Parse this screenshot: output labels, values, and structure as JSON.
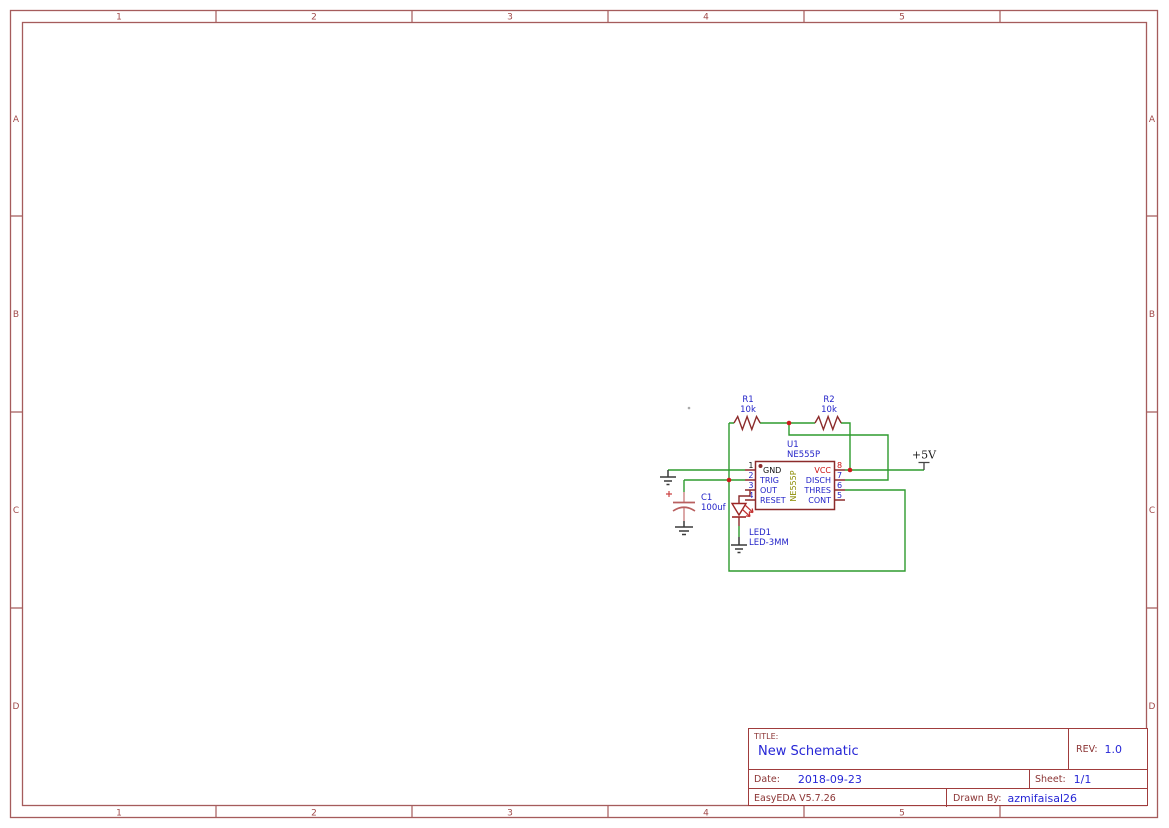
{
  "frame": {
    "columns": [
      "1",
      "2",
      "3",
      "4",
      "5"
    ],
    "rows": [
      "A",
      "B",
      "C",
      "D"
    ]
  },
  "title_block": {
    "title_label": "TITLE:",
    "title": "New Schematic",
    "rev_label": "REV:",
    "rev": "1.0",
    "date_label": "Date:",
    "date": "2018-09-23",
    "sheet_label": "Sheet:",
    "sheet": "1/1",
    "tool_version": "EasyEDA V5.7.26",
    "drawn_by_label": "Drawn By:",
    "drawn_by": "azmifaisal26"
  },
  "schematic": {
    "power_flag": "+5V",
    "resistors": [
      {
        "ref": "R1",
        "value": "10k"
      },
      {
        "ref": "R2",
        "value": "10k"
      }
    ],
    "ic": {
      "ref": "U1",
      "part": "NE555P",
      "body_label": "NE555P",
      "left_pins": [
        {
          "num": "1",
          "name": "GND"
        },
        {
          "num": "2",
          "name": "TRIG"
        },
        {
          "num": "3",
          "name": "OUT"
        },
        {
          "num": "4",
          "name": "RESET"
        }
      ],
      "right_pins": [
        {
          "num": "8",
          "name": "VCC"
        },
        {
          "num": "7",
          "name": "DISCH"
        },
        {
          "num": "6",
          "name": "THRES"
        },
        {
          "num": "5",
          "name": "CONT"
        }
      ]
    },
    "capacitor": {
      "ref": "C1",
      "value": "100uf"
    },
    "led": {
      "ref": "LED1",
      "value": "LED-3MM"
    }
  },
  "colors": {
    "wire_green": "#2e9b2e",
    "symbol_dark_red": "#8c2b2b",
    "junction_red": "#cc1a1a",
    "label_blue": "#2323c8",
    "pin_red": "#cc1111",
    "pin_black": "#111111",
    "ic_body_label_olive": "#8b8b00",
    "frame_line": "#a55c5c",
    "title_border": "#a03c3c",
    "title_value_blue": "#2626d6",
    "title_label_maroon": "#8b3434",
    "ground_dark": "#3a3a3a",
    "capacitor_pink": "#c87a7a"
  }
}
